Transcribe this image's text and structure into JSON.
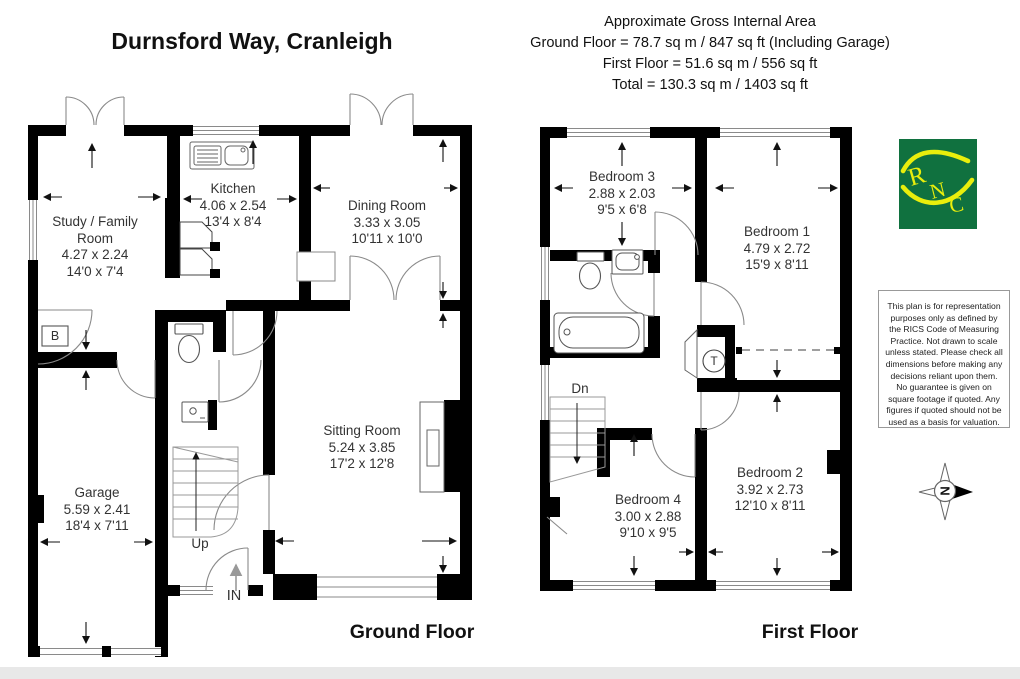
{
  "title": "Durnsford Way, Cranleigh",
  "area_summary": {
    "lines": [
      "Approximate Gross Internal Area",
      "Ground Floor = 78.7 sq m / 847 sq ft (Including Garage)",
      "First Floor = 51.6 sq m / 556 sq ft",
      "Total = 130.3 sq m / 1403 sq ft"
    ]
  },
  "ground_floor": {
    "label": "Ground Floor",
    "rooms": {
      "study": {
        "name": "Study / Family Room",
        "metric": "4.27 x 2.24",
        "imperial": "14'0 x 7'4"
      },
      "kitchen": {
        "name": "Kitchen",
        "metric": "4.06 x 2.54",
        "imperial": "13'4 x 8'4"
      },
      "dining": {
        "name": "Dining Room",
        "metric": "3.33 x 3.05",
        "imperial": "10'11 x 10'0"
      },
      "sitting": {
        "name": "Sitting Room",
        "metric": "5.24 x 3.85",
        "imperial": "17'2 x 12'8"
      },
      "garage": {
        "name": "Garage",
        "metric": "5.59 x 2.41",
        "imperial": "18'4 x 7'11"
      }
    },
    "stairs_label": "Up",
    "entrance_label": "IN",
    "boiler_label": "B"
  },
  "first_floor": {
    "label": "First Floor",
    "rooms": {
      "bedroom1": {
        "name": "Bedroom 1",
        "metric": "4.79 x 2.72",
        "imperial": "15'9 x 8'11"
      },
      "bedroom2": {
        "name": "Bedroom 2",
        "metric": "3.92 x 2.73",
        "imperial": "12'10 x 8'11"
      },
      "bedroom3": {
        "name": "Bedroom 3",
        "metric": "2.88 x 2.03",
        "imperial": "9'5 x 6'8"
      },
      "bedroom4": {
        "name": "Bedroom 4",
        "metric": "3.00 x 2.88",
        "imperial": "9'10 x 9'5"
      }
    },
    "stairs_label": "Dn",
    "tank_label": "T"
  },
  "logo": {
    "letters": [
      "R",
      "N",
      "C"
    ],
    "bg_color": "#10713f",
    "fg_color": "#e9ee0c"
  },
  "disclaimer_text": "This plan is for representation purposes only as defined by the RICS Code of Measuring Practice. Not drawn to scale unless stated. Please check all dimensions before making any decisions reliant upon them. No guarantee is given on square footage if quoted. Any figures if quoted should not be used as a basis for valuation.",
  "compass": {
    "north_label": "N"
  },
  "colors": {
    "walls": "#000000",
    "fixture_lines": "#8a8a8a"
  }
}
